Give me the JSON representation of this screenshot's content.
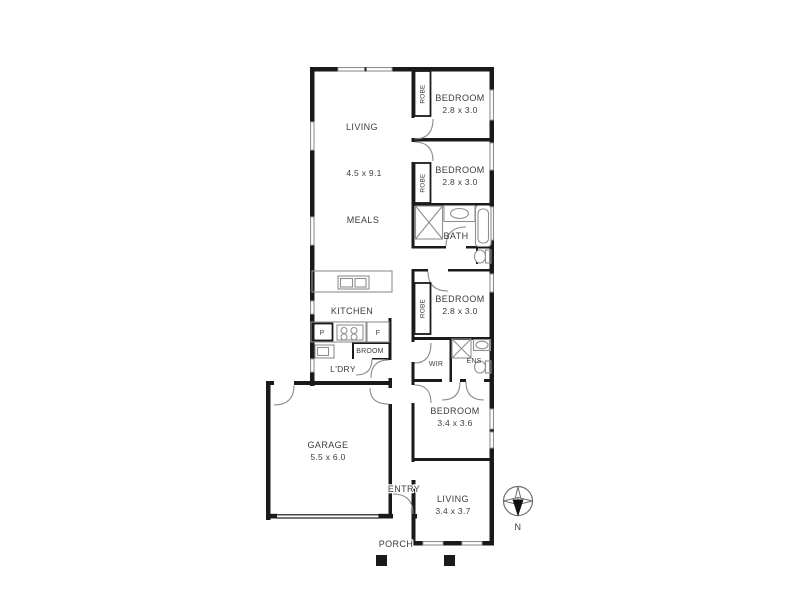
{
  "colors": {
    "wall": "#1a1a1a",
    "text": "#3c3c3c",
    "fixture_outline": "#8f8f8f",
    "background": "#ffffff"
  },
  "floorplan": {
    "rooms": [
      {
        "name": "LIVING",
        "dimensions": "4.5 x 9.1"
      },
      {
        "name": "MEALS"
      },
      {
        "name": "KITCHEN"
      },
      {
        "name": "BEDROOM",
        "dimensions": "2.8 x 3.0"
      },
      {
        "name": "BEDROOM",
        "dimensions": "2.8 x 3.0"
      },
      {
        "name": "BATH"
      },
      {
        "name": "BEDROOM",
        "dimensions": "2.8 x 3.0"
      },
      {
        "name": "WIR"
      },
      {
        "name": "ENS"
      },
      {
        "name": "BEDROOM",
        "dimensions": "3.4 x 3.6"
      },
      {
        "name": "LIVING",
        "dimensions": "3.4 x 3.7"
      },
      {
        "name": "GARAGE",
        "dimensions": "5.5 x 6.0"
      },
      {
        "name": "ENTRY"
      },
      {
        "name": "PORCH"
      },
      {
        "name": "L'DRY"
      },
      {
        "name": "BROOM"
      }
    ],
    "closets": [
      {
        "name": "ROBE"
      },
      {
        "name": "ROBE"
      },
      {
        "name": "ROBE"
      }
    ],
    "appliance_labels": [
      {
        "name": "P"
      },
      {
        "name": "F"
      }
    ],
    "compass": {
      "north": "N"
    }
  }
}
